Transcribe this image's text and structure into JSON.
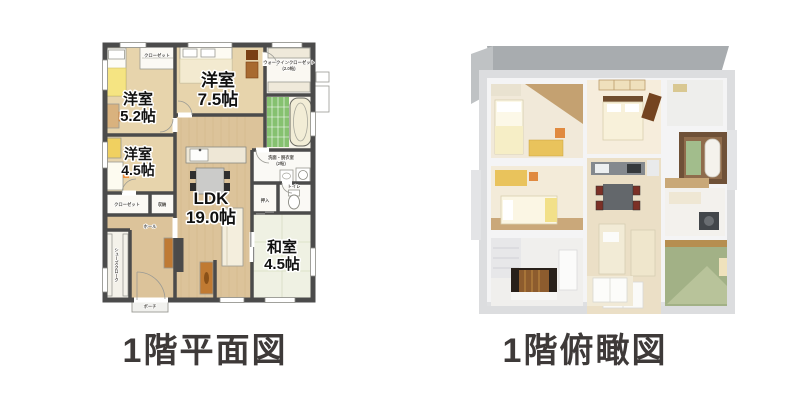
{
  "page": {
    "background": "#ffffff"
  },
  "palette": {
    "wall": "#4b4b4b",
    "wood_floor": "#dcc39a",
    "tatami": "#eff1e3",
    "bath_tile": "#86c170",
    "blanket_yellow": "#f5e482",
    "chair_orange": "#ef8f3c",
    "caption_text": "#3e3a39",
    "roof_gray": "#a8acaf",
    "tatami_3d": "#a2b186",
    "genkan_dark": "#28201a"
  },
  "floor_plan": {
    "caption": "1階平面図",
    "rooms": [
      {
        "name": "洋室",
        "size": "5.2帖"
      },
      {
        "name": "洋室",
        "size": "7.5帖"
      },
      {
        "name": "洋室",
        "size": "4.5帖"
      },
      {
        "name": "LDK",
        "size": "19.0帖"
      },
      {
        "name": "和室",
        "size": "4.5帖"
      }
    ],
    "labels": {
      "closet_bedroom52": "クローゼット",
      "wic": "ウォークインクローゼット",
      "wic_size": "(2.0帖)",
      "washroom": "洗面・脱衣室",
      "washroom_size": "(2帖)",
      "toilet": "トイレ",
      "oshiire": "押入",
      "storage": "収納",
      "closet_bedroom45": "クローゼット",
      "hall": "ホール",
      "shoes_cloak": "シューズクローク",
      "porch": "ポーチ"
    }
  },
  "overhead_view": {
    "caption": "1階俯瞰図"
  }
}
